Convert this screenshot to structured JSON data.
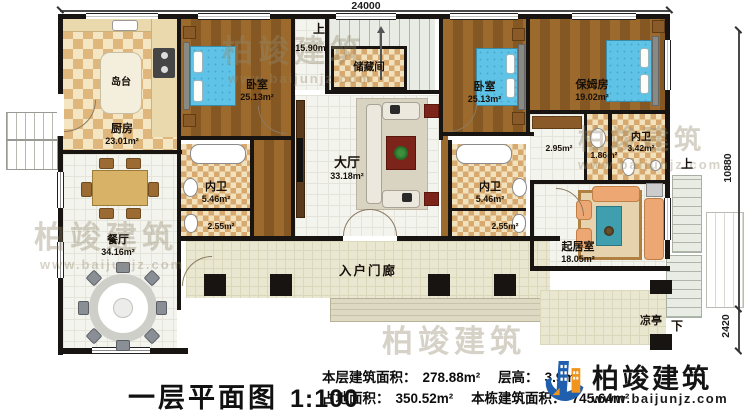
{
  "dimensions": {
    "width_top": "24000",
    "height_right": "10880",
    "stair_right": "2420"
  },
  "stairs": {
    "up_interior": "上",
    "up_exterior": "上",
    "down_exterior": "下"
  },
  "rooms": {
    "kitchen": {
      "name": "厨房",
      "area": "23.01m²"
    },
    "island": {
      "name": "岛台"
    },
    "bedroom_left": {
      "name": "卧室",
      "area": "25.13m²"
    },
    "stair_hall": {
      "area": "15.90m²"
    },
    "storage": {
      "name": "储藏间"
    },
    "hall": {
      "name": "大厅",
      "area": "33.18m²"
    },
    "bedroom_mid": {
      "name": "卧室",
      "area": "25.13m²"
    },
    "nanny_room": {
      "name": "保姆房",
      "area": "19.02m²"
    },
    "bath_left": {
      "name": "内卫",
      "area": "5.46m²",
      "toilet_area": "2.55m²"
    },
    "bath_mid": {
      "name": "内卫",
      "area": "5.46m²",
      "toilet_area": "2.55m²"
    },
    "bath_right": {
      "name": "内卫",
      "area": "3.42m²"
    },
    "closet": {
      "area": "2.95m²"
    },
    "washroom": {
      "area": "1.86m²"
    },
    "dining": {
      "name": "餐厅",
      "area": "34.16m²"
    },
    "living": {
      "name": "起居室",
      "area": "18.05m²"
    },
    "porch": {
      "name": "入户门廊"
    },
    "pavilion": {
      "name": "凉亭"
    }
  },
  "footer": {
    "title": "一层平面图",
    "scale": "1:100",
    "stats": {
      "floor_area_label": "本层建筑面积：",
      "floor_area": "278.88m²",
      "height_label": "层高：",
      "height": "3.9m",
      "land_area_label": "占地面积：",
      "land_area": "350.52m²",
      "building_area_label": "本栋建筑面积：",
      "building_area": "745.64m²"
    }
  },
  "branding": {
    "company": "柏竣建筑",
    "website": "www.baijunjz.com"
  },
  "watermark": {
    "text": "柏竣建筑",
    "sub": "www.baijunjz.com"
  }
}
